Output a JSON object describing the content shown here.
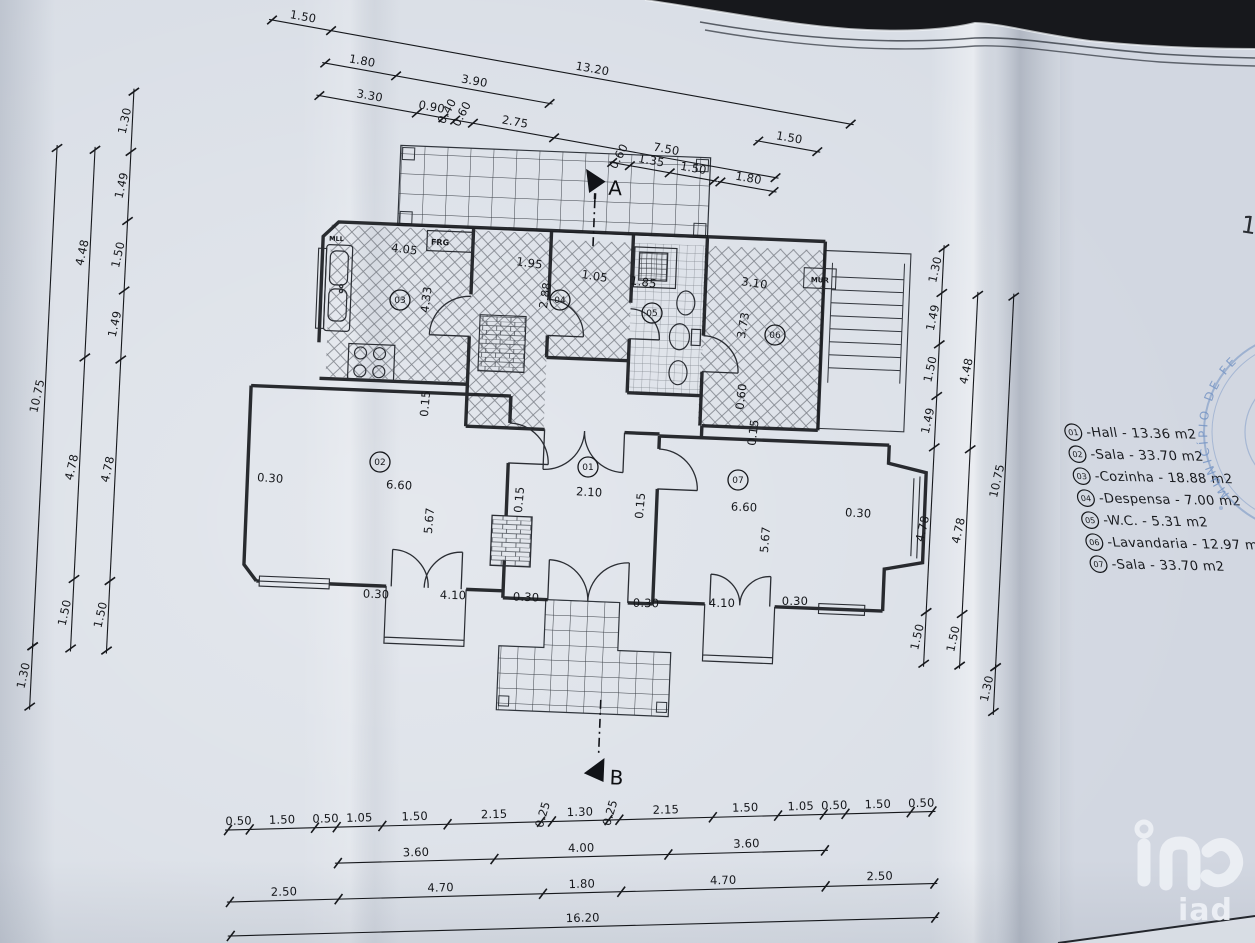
{
  "scene": {
    "background_color": "#17181c",
    "paper_color": "#d9dee6",
    "line_color": "#1b1d21",
    "stamp_color": "#6488c0",
    "watermark_color": "#edf0f5"
  },
  "sheet": {
    "partial_number": "1"
  },
  "plan": {
    "section_markers": {
      "top": "A",
      "bottom": "B"
    },
    "fixture_labels": {
      "sink_unit": "MLL",
      "fridge": "FRG",
      "wall": "MUR"
    },
    "room_circles": [
      "01",
      "02",
      "03",
      "04",
      "05",
      "06",
      "07"
    ]
  },
  "legend": {
    "items": [
      {
        "num": "01",
        "name": "Hall",
        "area_m2": "13.36"
      },
      {
        "num": "02",
        "name": "Sala",
        "area_m2": "33.70"
      },
      {
        "num": "03",
        "name": "Cozinha",
        "area_m2": "18.88"
      },
      {
        "num": "04",
        "name": "Despensa",
        "area_m2": "7.00"
      },
      {
        "num": "05",
        "name": "W.C.",
        "area_m2": "5.31"
      },
      {
        "num": "06",
        "name": "Lavandaria",
        "area_m2": "12.97"
      },
      {
        "num": "07",
        "name": "Sala",
        "area_m2": "33.70"
      }
    ]
  },
  "stamp": {
    "text": "MUNICÍPIO DE FER"
  },
  "watermark": {
    "text": "iad"
  },
  "dims": {
    "top": {
      "row1": [
        "1.50",
        "13.20"
      ],
      "row2": [
        "1.80",
        "3.90"
      ],
      "row2b": [
        "1.50"
      ],
      "row3": [
        "3.30",
        "0.90",
        "0.40",
        "0.60",
        "2.75",
        "7.50"
      ],
      "row4": [
        "0.60",
        "1.35",
        "1.50"
      ],
      "row4b": [
        "1.80"
      ]
    },
    "bottom": {
      "row1": [
        "0.50",
        "1.50",
        "0.50",
        "1.05",
        "1.50",
        "2.15",
        "0.25",
        "1.30",
        "0.25",
        "2.15",
        "1.50",
        "1.05",
        "0.50",
        "1.50",
        "0.50"
      ],
      "row2": [
        "3.60",
        "4.00",
        "3.60"
      ],
      "row3": [
        "2.50",
        "4.70",
        "1.80",
        "4.70",
        "2.50"
      ],
      "row4": [
        "16.20"
      ]
    },
    "left": {
      "inner": [
        "1.30",
        "1.49",
        "1.50",
        "1.49",
        "4.78",
        "1.50"
      ],
      "mid": [
        "4.48",
        "4.78",
        "1.50"
      ],
      "outer": [
        "10.75"
      ],
      "outer2": [
        "1.30"
      ]
    },
    "right": {
      "inner": [
        "1.30",
        "1.49",
        "1.50",
        "1.49",
        "4.78",
        "1.50"
      ],
      "mid": [
        "4.48",
        "4.78",
        "1.50"
      ],
      "outer": [
        "10.75"
      ],
      "outer2": [
        "1.30"
      ]
    },
    "interior": [
      "4.05",
      "4.33",
      "1.95",
      "2.88",
      "1.05",
      "1.85",
      "3.10",
      "3.73",
      "0.15",
      "0.30",
      "6.60",
      "0.15",
      "5.67",
      "2.10",
      "0.15",
      "6.60",
      "5.67",
      "0.30",
      "0.30",
      "4.10",
      "0.30",
      "0.30",
      "4.10",
      "0.30",
      "0.60",
      "0.15"
    ]
  }
}
